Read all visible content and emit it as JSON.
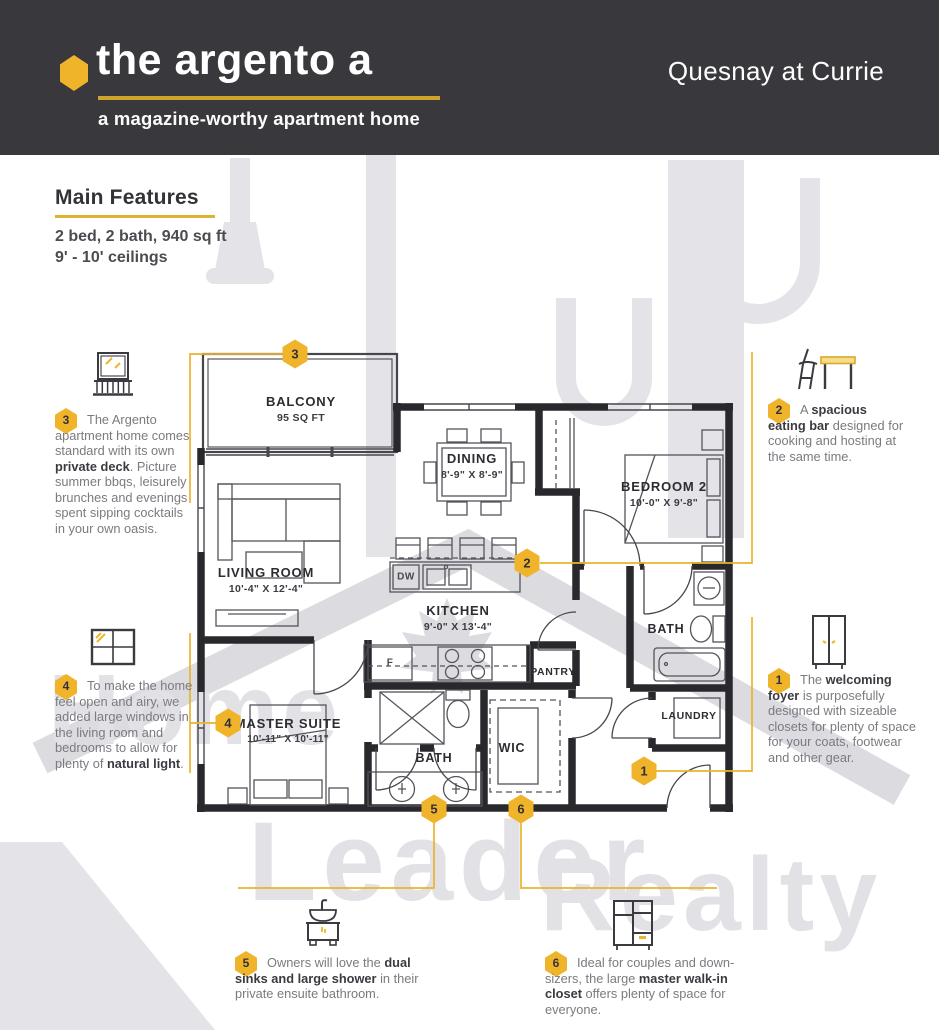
{
  "header": {
    "title": "the argento a",
    "subtitle": "a magazine-worthy apartment home",
    "project": "Quesnay at Currie"
  },
  "features": {
    "heading": "Main Features",
    "specs": "2 bed, 2 bath, 940 sq ft",
    "ceilings": "9' - 10' ceilings"
  },
  "watermark": {
    "word1": "Home",
    "word2": "Leader",
    "word3": "Realty"
  },
  "floorplan": {
    "rooms": {
      "balcony": {
        "name": "BALCONY",
        "dim": "95 SQ FT"
      },
      "dining": {
        "name": "DINING",
        "dim": "8'-9\" X 8'-9\""
      },
      "bedroom2": {
        "name": "BEDROOM 2",
        "dim": "10'-0\" X 9'-8\""
      },
      "living": {
        "name": "LIVING ROOM",
        "dim": "10'-4\" X 12'-4\""
      },
      "kitchen": {
        "name": "KITCHEN",
        "dim": "9'-0\" X 13'-4\""
      },
      "master": {
        "name": "MASTER SUITE",
        "dim": "10'-11\" X 10'-11\""
      },
      "bath_main": {
        "name": "BATH"
      },
      "bath_ensuite": {
        "name": "BATH"
      },
      "wic": {
        "name": "WIC"
      },
      "pantry": {
        "name": "PANTRY"
      },
      "laundry": {
        "name": "LAUNDRY"
      }
    },
    "appliances": {
      "dishwasher": "DW",
      "fridge": "F"
    }
  },
  "callouts": {
    "c1": {
      "num": "1",
      "segments": [
        {
          "t": "The ",
          "b": 0
        },
        {
          "t": "welcoming foyer",
          "b": 1
        },
        {
          "t": " is purposefully designed with sizeable closets for plenty of space for your coats, footwear and other gear.",
          "b": 0
        }
      ]
    },
    "c2": {
      "num": "2",
      "segments": [
        {
          "t": "A ",
          "b": 0
        },
        {
          "t": "spacious eating bar",
          "b": 1
        },
        {
          "t": " designed for cooking and hosting at the same time.",
          "b": 0
        }
      ]
    },
    "c3": {
      "num": "3",
      "segments": [
        {
          "t": "The Argento apartment home comes standard with its own ",
          "b": 0
        },
        {
          "t": "private deck",
          "b": 1
        },
        {
          "t": ". Picture summer bbqs, leisurely brunches and evenings spent sipping cocktails in your own oasis.",
          "b": 0
        }
      ]
    },
    "c4": {
      "num": "4",
      "segments": [
        {
          "t": "To make the home feel open and airy, we added large windows in the living room and bedrooms to allow for plenty of ",
          "b": 0
        },
        {
          "t": "natural light",
          "b": 1
        },
        {
          "t": ".",
          "b": 0
        }
      ]
    },
    "c5": {
      "num": "5",
      "segments": [
        {
          "t": "Owners will love the ",
          "b": 0
        },
        {
          "t": "dual sinks and large shower",
          "b": 1
        },
        {
          "t": " in their private ensuite bathroom.",
          "b": 0
        }
      ]
    },
    "c6": {
      "num": "6",
      "segments": [
        {
          "t": "Ideal for couples and down-sizers, the large ",
          "b": 0
        },
        {
          "t": "master walk-in closet",
          "b": 1
        },
        {
          "t": " offers plenty of space for everyone.",
          "b": 0
        }
      ]
    }
  },
  "colors": {
    "gold": "#EFB429",
    "header_bg": "#39383D",
    "wall": "#29282D",
    "watermark": "#E4E3E7"
  }
}
